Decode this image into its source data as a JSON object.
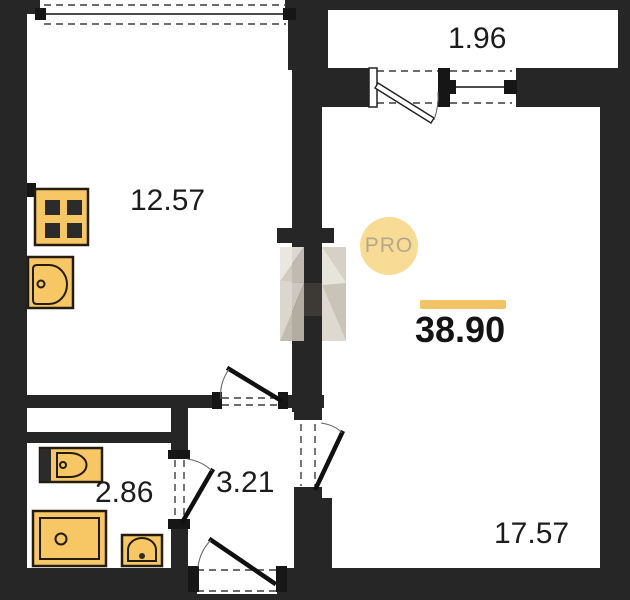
{
  "watermark": {
    "label": "PRO"
  },
  "total": {
    "area": "38.90"
  },
  "rooms": {
    "kitchen": {
      "area": "12.57"
    },
    "balcony": {
      "area": "1.96"
    },
    "living": {
      "area": "17.57"
    },
    "hallway": {
      "area": "3.21"
    },
    "bathroom": {
      "area": "2.86"
    }
  },
  "icons": {
    "stove": "stove-icon",
    "kitchen_sink": "kitchen-sink-icon",
    "toilet": "toilet-icon",
    "shower": "shower-tray-icon",
    "washbasin": "washbasin-icon",
    "watermark_logo": "faceted-logo-icon"
  },
  "colors": {
    "wall": "#262626",
    "fixture_fill": "#f7c766",
    "fixture_stroke": "#241c0e",
    "accent_bar": "#f2c364",
    "badge_bg": "#f8db95",
    "badge_text": "#b3a88e",
    "line": "#3c3c3c",
    "label_text": "#1c1c1c"
  }
}
